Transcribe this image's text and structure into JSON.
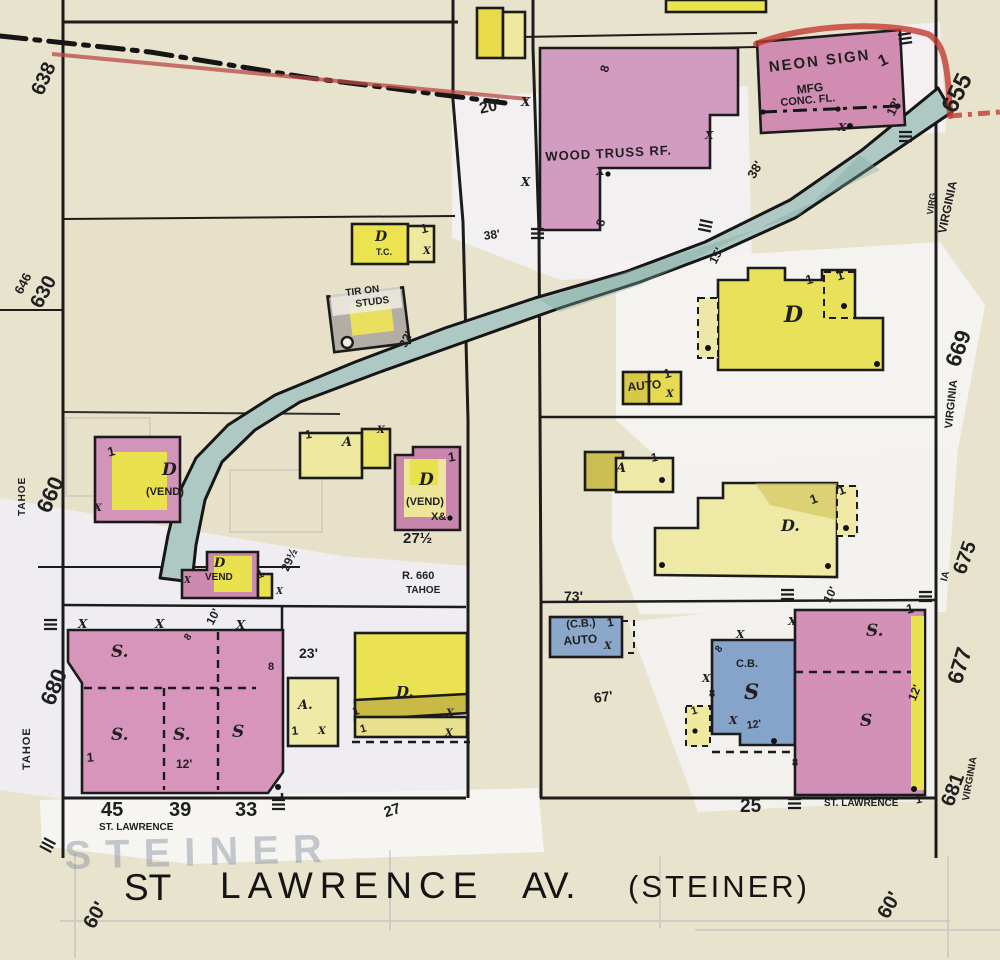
{
  "map_type": "fire-insurance-map",
  "sheet": {
    "block_number": "455"
  },
  "colors": {
    "paper": "#e8e3cd",
    "patch_white": "#f3f1ee",
    "brick_pink": "#d394b9",
    "frame_yellow": "#ece44f",
    "pale_yellow": "#efe9a0",
    "concrete_blue": "#8aa7cb",
    "creek_teal": "#aec9c3",
    "red_marking": "#c0403c"
  },
  "texts": {
    "one": "1",
    "x": "X",
    "eight": "8",
    "d60": "60'",
    "d12": "12'",
    "d38": "38'",
    "d10": "10'",
    "d20": "20'",
    "d15": "15'",
    "d23": "23'",
    "d32": "32'",
    "d73": "73'",
    "d67": "67'",
    "d275": "27½",
    "d295": "29½",
    "m638": "638",
    "m646": "646",
    "m630": "630",
    "m660": "660",
    "m680": "680",
    "m655": "655",
    "m669": "669",
    "m675": "675",
    "m677": "677",
    "m681": "681",
    "tahoe": "TAHOE",
    "virginia": "VIRGINIA",
    "virg": "VIRG",
    "ia": "IA",
    "woodtruss": "WOOD TRUSS RF.",
    "neon1": "NEON SIGN",
    "neon2": "MFG",
    "neon3": "CONC. FL.",
    "tc": "T.C.",
    "tiron1": "TIR ON",
    "tiron2": "STUDS",
    "auto": "AUTO",
    "cb_paren": "(C.B.)",
    "cb": "C.B.",
    "d_letter": "D",
    "d_dot": "D.",
    "a_letter": "A",
    "a_dot": "A.",
    "s_dot": "S.",
    "s_plain": "S",
    "vend_paren": "(VEND)",
    "vend": "VEND",
    "x_amp": "X&",
    "r660": "R. 660",
    "n45": "45",
    "n39": "39",
    "n33": "33",
    "n27": "27",
    "n25": "25",
    "stlawrence_small": "ST. LAWRENCE",
    "ghost_steiner": "STEINER",
    "street_st": "ST",
    "street_lawrence": "LAWRENCE",
    "street_av": "AV.",
    "street_steiner": "(STEINER)"
  }
}
